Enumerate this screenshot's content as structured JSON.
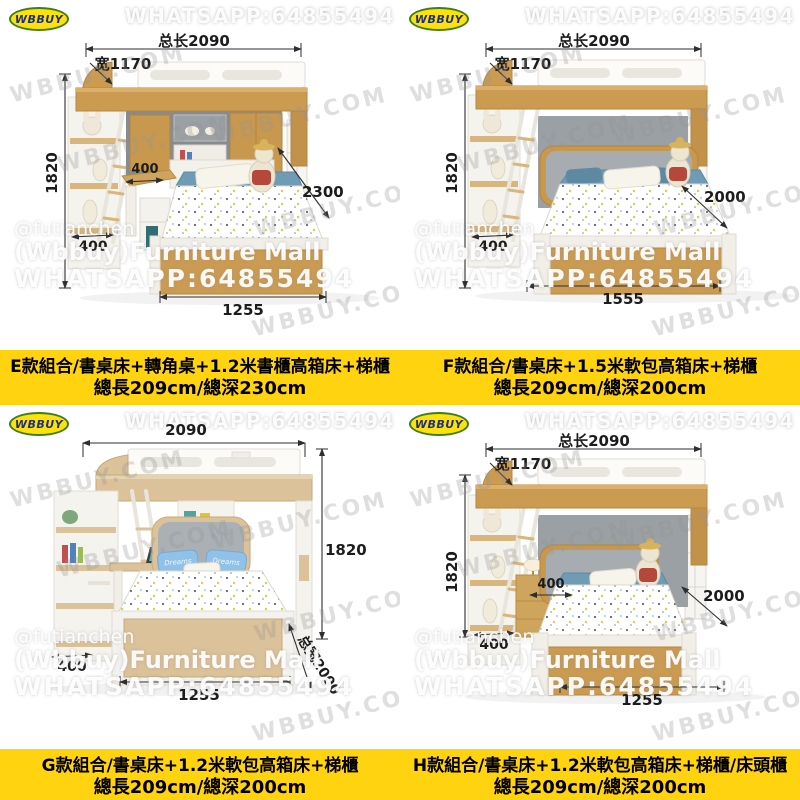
{
  "brand_logo": {
    "text": "WBBUY"
  },
  "watermarks": {
    "top": "WHATSAPP:64855494",
    "diagonal": "WBBUY.COM",
    "seller": [
      "@futianchen",
      "(Wbbuy)Furniture Mall",
      "WHATSAPP:64855494"
    ]
  },
  "colors": {
    "caption_band": "#FFD30F",
    "logo_fill": "#FFE10A",
    "logo_border": "#3F7D1C",
    "logo_text": "#1D2F80",
    "wood": "#CB9B52",
    "light_wood": "#DCC29A",
    "wall_gray": "#9AA0A3"
  },
  "panels": [
    {
      "id": "E",
      "dims": {
        "total_length": "总长2090",
        "width": "宽1170",
        "height": "1820",
        "desk_depth": "400",
        "ladder_depth": "400",
        "diag_depth": "2300",
        "bed_length": "1255"
      },
      "caption": {
        "line1": "E款組合/書桌床+轉角桌+1.2米書櫃高箱床+梯櫃",
        "line2": "總長209cm/總深230cm"
      }
    },
    {
      "id": "F",
      "dims": {
        "total_length": "总长2090",
        "width": "宽1170",
        "height": "1820",
        "ladder_depth": "400",
        "diag_depth": "2000",
        "bed_length": "1555"
      },
      "caption": {
        "line1": "F款組合/書桌床+1.5米軟包高箱床+梯櫃",
        "line2": "總長209cm/總深200cm"
      }
    },
    {
      "id": "G",
      "dims": {
        "total_length": "2090",
        "height": "1820",
        "ladder_depth": "400",
        "diag_depth": "总宽2000",
        "bed_length": "1255"
      },
      "pillow_text": "Dreams",
      "caption": {
        "line1": "G款組合/書桌床+1.2米軟包高箱床+梯櫃",
        "line2": "總長209cm/總深200cm"
      }
    },
    {
      "id": "H",
      "dims": {
        "total_length": "总长2090",
        "width": "宽1170",
        "height": "1820",
        "nightstand_depth": "400",
        "ladder_depth": "400",
        "diag_depth": "2000",
        "bed_length": "1255"
      },
      "caption": {
        "line1": "H款組合/書桌床+1.2米軟包高箱床+梯櫃/床頭櫃",
        "line2": "總長209cm/總深200cm"
      }
    }
  ]
}
